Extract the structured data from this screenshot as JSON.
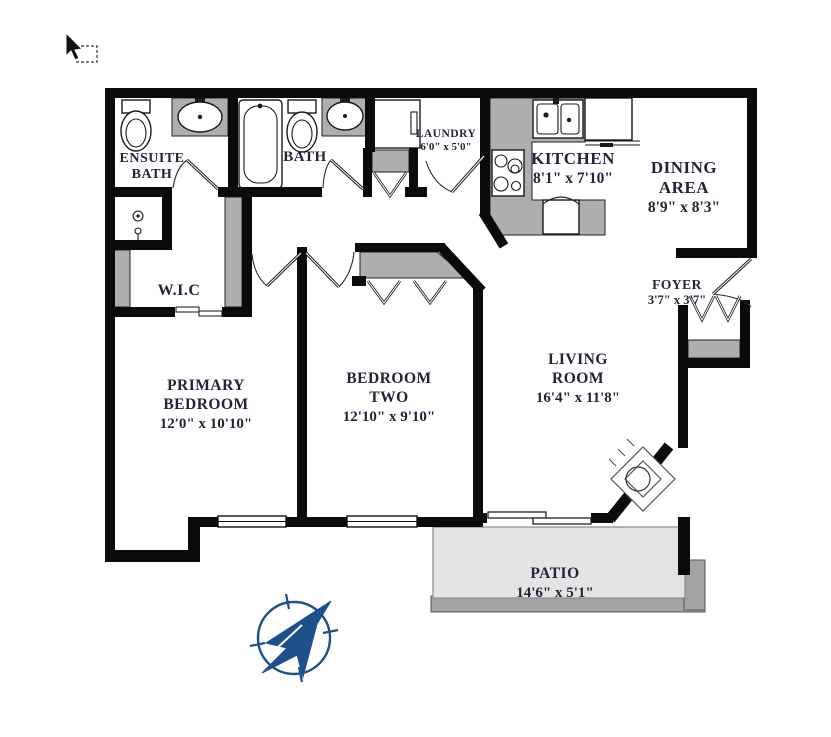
{
  "document": {
    "type": "apartment-floor-plan",
    "background": "#ffffff"
  },
  "rooms": {
    "ensuite_bath": {
      "name_line1": "ENSUITE",
      "name_line2": "BATH"
    },
    "bath": {
      "name": "BATH"
    },
    "laundry": {
      "name": "LAUNDRY",
      "dims": "6'0\" x 5'0\""
    },
    "kitchen": {
      "name": "KITCHEN",
      "dims": "8'1\" x 7'10\""
    },
    "dining_area": {
      "name_line1": "DINING",
      "name_line2": "AREA",
      "dims": "8'9\" x 8'3\""
    },
    "foyer": {
      "name": "FOYER",
      "dims": "3'7\" x 3'7\""
    },
    "wic": {
      "name": "W.I.C"
    },
    "primary_bedroom": {
      "name_line1": "PRIMARY",
      "name_line2": "BEDROOM",
      "dims": "12'0\" x 10'10\""
    },
    "bedroom_two": {
      "name_line1": "BEDROOM",
      "name_line2": "TWO",
      "dims": "12'10\" x 9'10\""
    },
    "living_room": {
      "name_line1": "LIVING",
      "name_line2": "ROOM",
      "dims": "16'4\" x 11'8\""
    },
    "patio": {
      "name": "PATIO",
      "dims": "14'6\" x 5'1\""
    }
  },
  "icons": [
    "cursor-arrow-icon",
    "selection-box-icon",
    "compass-north-arrow-icon",
    "toilet-icon",
    "sink-icon",
    "bathtub-icon",
    "shower-icon",
    "washer-icon",
    "kitchen-sink-icon",
    "stove-icon",
    "fridge-icon",
    "dishwasher-icon",
    "fireplace-icon",
    "door-swing-icon",
    "bifold-door-icon",
    "window-icon",
    "sliding-door-icon"
  ],
  "colors": {
    "wall": "#0b0b0b",
    "closet_counter_gray": "#aeaeae",
    "patio_fill": "#e4e4e4",
    "patio_edge_gray": "#a3a3a3",
    "compass_blue": "#1d4f8b",
    "label_text": "#23233a"
  }
}
